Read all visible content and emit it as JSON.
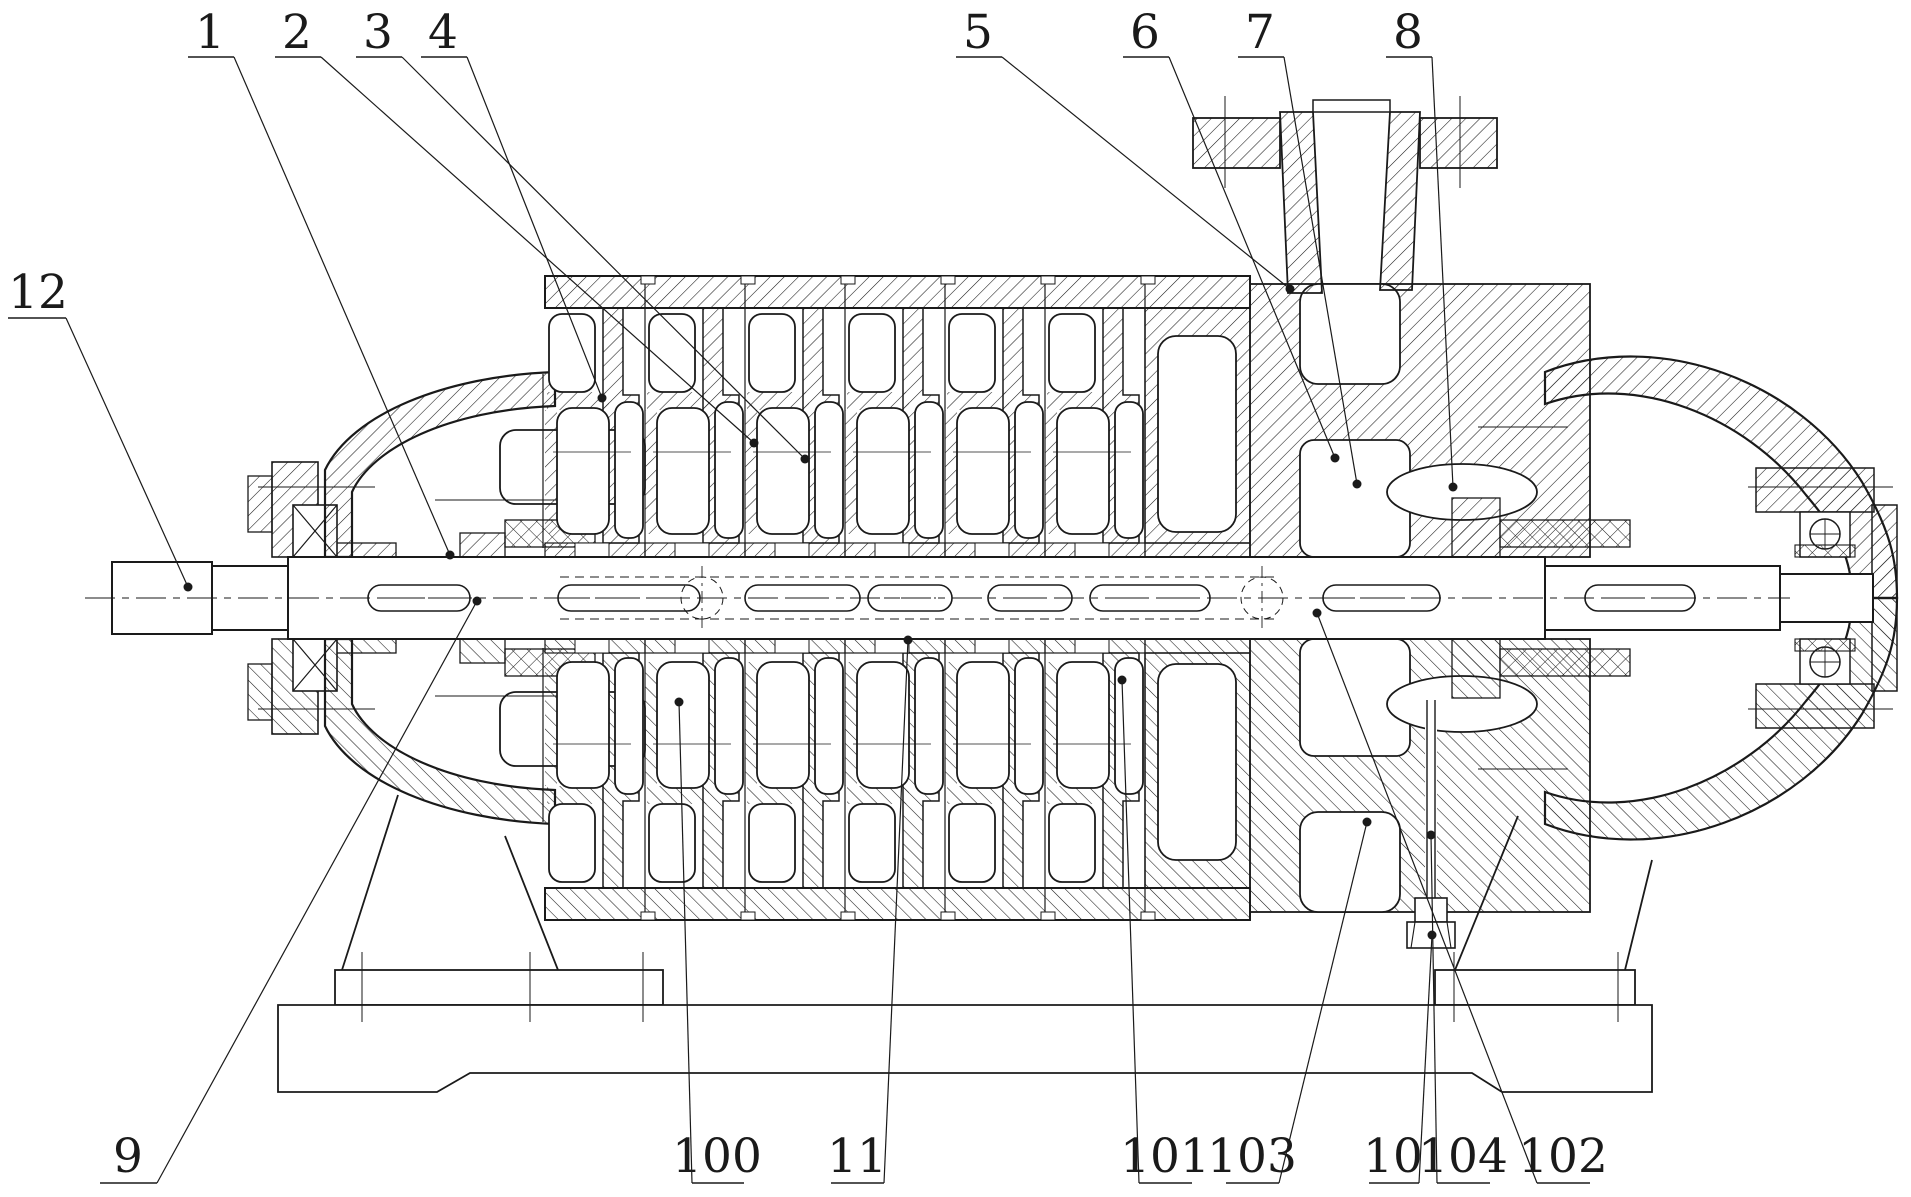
{
  "drawing": {
    "title": "multistage-pump-sectional-view",
    "width": 1911,
    "height": 1197,
    "line_color": "#1a1a1a",
    "background_color": "#ffffff",
    "reference_labels": [
      {
        "text": "1",
        "tx": 210,
        "ty": 48,
        "ul": [
          188,
          234,
          57
        ],
        "leader": [
          234,
          57,
          450,
          555
        ],
        "dot": true
      },
      {
        "text": "2",
        "tx": 297,
        "ty": 48,
        "ul": [
          275,
          321,
          57
        ],
        "leader": [
          321,
          57,
          754,
          443
        ],
        "dot": true
      },
      {
        "text": "3",
        "tx": 378,
        "ty": 48,
        "ul": [
          356,
          402,
          57
        ],
        "leader": [
          402,
          57,
          805,
          459
        ],
        "dot": true
      },
      {
        "text": "4",
        "tx": 443,
        "ty": 48,
        "ul": [
          421,
          467,
          57
        ],
        "leader": [
          467,
          57,
          602,
          398
        ],
        "dot": true
      },
      {
        "text": "5",
        "tx": 978,
        "ty": 48,
        "ul": [
          956,
          1002,
          57
        ],
        "leader": [
          1002,
          57,
          1290,
          289
        ],
        "dot": true
      },
      {
        "text": "6",
        "tx": 1145,
        "ty": 48,
        "ul": [
          1123,
          1169,
          57
        ],
        "leader": [
          1169,
          57,
          1335,
          458
        ],
        "dot": true
      },
      {
        "text": "7",
        "tx": 1260,
        "ty": 48,
        "ul": [
          1238,
          1284,
          57
        ],
        "leader": [
          1284,
          57,
          1357,
          484
        ],
        "dot": true
      },
      {
        "text": "8",
        "tx": 1408,
        "ty": 48,
        "ul": [
          1386,
          1432,
          57
        ],
        "leader": [
          1432,
          57,
          1453,
          487
        ],
        "dot": true
      },
      {
        "text": "12",
        "tx": 38,
        "ty": 308,
        "ul": [
          8,
          66,
          318
        ],
        "leader": [
          66,
          318,
          188,
          587
        ],
        "dot": true
      },
      {
        "text": "9",
        "tx": 128,
        "ty": 1172,
        "ul": [
          100,
          157,
          1183
        ],
        "leader": [
          157,
          1183,
          477,
          601
        ],
        "dot": true
      },
      {
        "text": "100",
        "tx": 717,
        "ty": 1172,
        "ul": [
          692,
          744,
          1183
        ],
        "leader": [
          692,
          1183,
          679,
          702
        ],
        "dot": true
      },
      {
        "text": "11",
        "tx": 857,
        "ty": 1172,
        "ul": [
          831,
          884,
          1183
        ],
        "leader": [
          884,
          1183,
          908,
          640
        ],
        "dot": true
      },
      {
        "text": "101",
        "tx": 1165,
        "ty": 1172,
        "ul": [
          1139,
          1192,
          1183
        ],
        "leader": [
          1139,
          1183,
          1122,
          680
        ],
        "dot": true
      },
      {
        "text": "103",
        "tx": 1252,
        "ty": 1172,
        "ul": [
          1226,
          1279,
          1183
        ],
        "leader": [
          1279,
          1183,
          1367,
          822
        ],
        "dot": true
      },
      {
        "text": "10",
        "tx": 1393,
        "ty": 1172,
        "ul": [
          1369,
          1419,
          1183
        ],
        "leader": [
          1419,
          1183,
          1432,
          935
        ],
        "dot": true
      },
      {
        "text": "104",
        "tx": 1463,
        "ty": 1172,
        "ul": [
          1437,
          1490,
          1183
        ],
        "leader": [
          1437,
          1183,
          1431,
          835
        ],
        "dot": true
      },
      {
        "text": "102",
        "tx": 1563,
        "ty": 1172,
        "ul": [
          1537,
          1590,
          1183
        ],
        "leader": [
          1537,
          1183,
          1317,
          613
        ],
        "dot": true
      }
    ]
  }
}
